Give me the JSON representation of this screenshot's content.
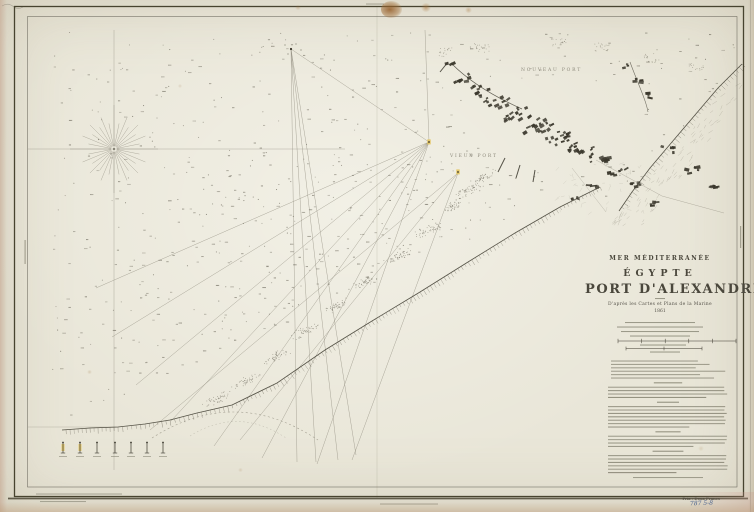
{
  "title_block": {
    "sea_region": "MER MÉDITERRANÉE",
    "country": "ÉGYPTE",
    "title": "PORT D'ALEXANDRIE",
    "source_line": "D'après les Cartes et Plans de la Marine",
    "year": "1861"
  },
  "map_labels": {
    "new_port": "NOUVEAU PORT",
    "old_port": "VIEUX PORT"
  },
  "margin": {
    "price": "Prix : Deux Francs",
    "catalog_number": "787 5-8"
  },
  "render": {
    "seed": 1861,
    "sounding_candidates": 2600,
    "colors": {
      "paper": "#e9e6d8",
      "ink_dark": "#3a372c",
      "ink_mid": "#6b675a",
      "ink_light": "#8d897b",
      "bar": "#82806f",
      "yellow": "#e3c35a",
      "blue": "#49618e",
      "stain": "#a8763f"
    }
  }
}
